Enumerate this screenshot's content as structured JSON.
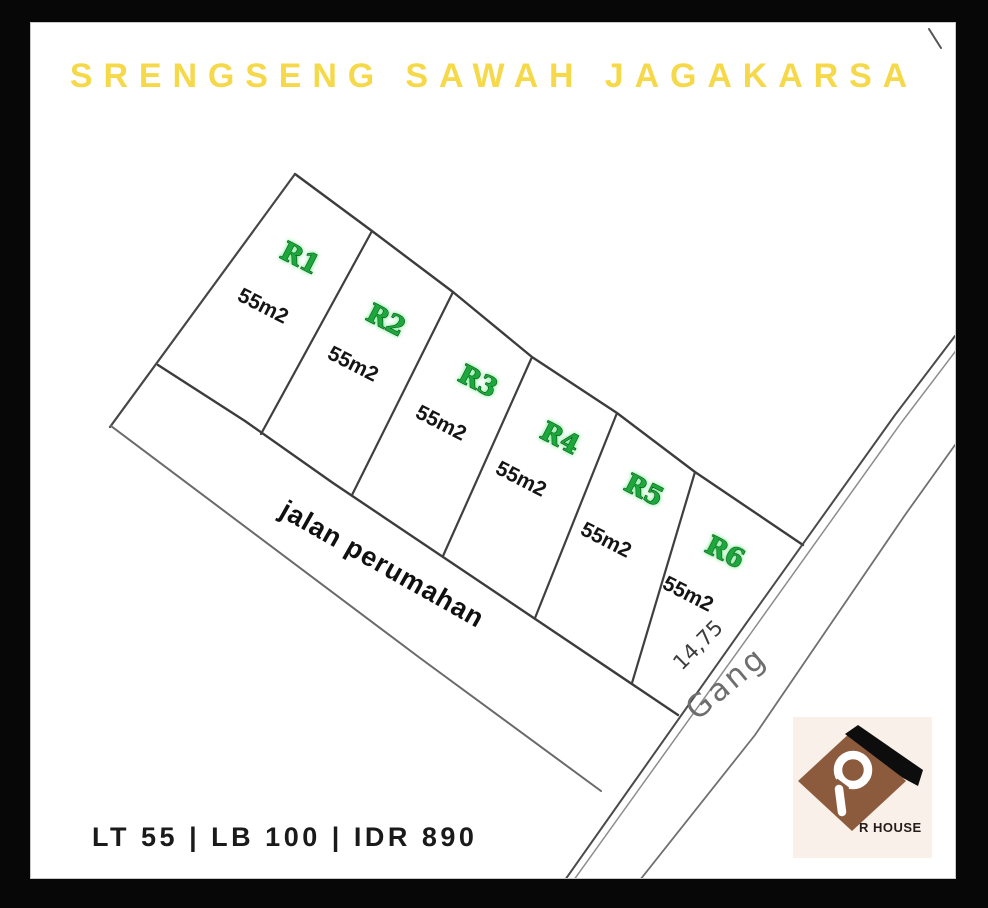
{
  "title": "SRENGSENG SAWAH JAGAKARSA",
  "plots": [
    {
      "name": "R1",
      "area": "55m2"
    },
    {
      "name": "R2",
      "area": "55m2"
    },
    {
      "name": "R3",
      "area": "55m2"
    },
    {
      "name": "R4",
      "area": "55m2"
    },
    {
      "name": "R5",
      "area": "55m2"
    },
    {
      "name": "R6",
      "area": "55m2"
    }
  ],
  "labels": {
    "road": "jalan perumahan",
    "alley": "Gang",
    "dimension": "14,75"
  },
  "footer": {
    "text": "LT 55 | LB 100 | IDR 890"
  },
  "logo": {
    "brand": "R HOUSE"
  },
  "colors": {
    "title_yellow": "#F5D94A",
    "plot_green": "#1FA83C",
    "line_gray": "#3F3F3F",
    "brand_brown": "#8C5B3D",
    "frame_black": "#070707"
  }
}
